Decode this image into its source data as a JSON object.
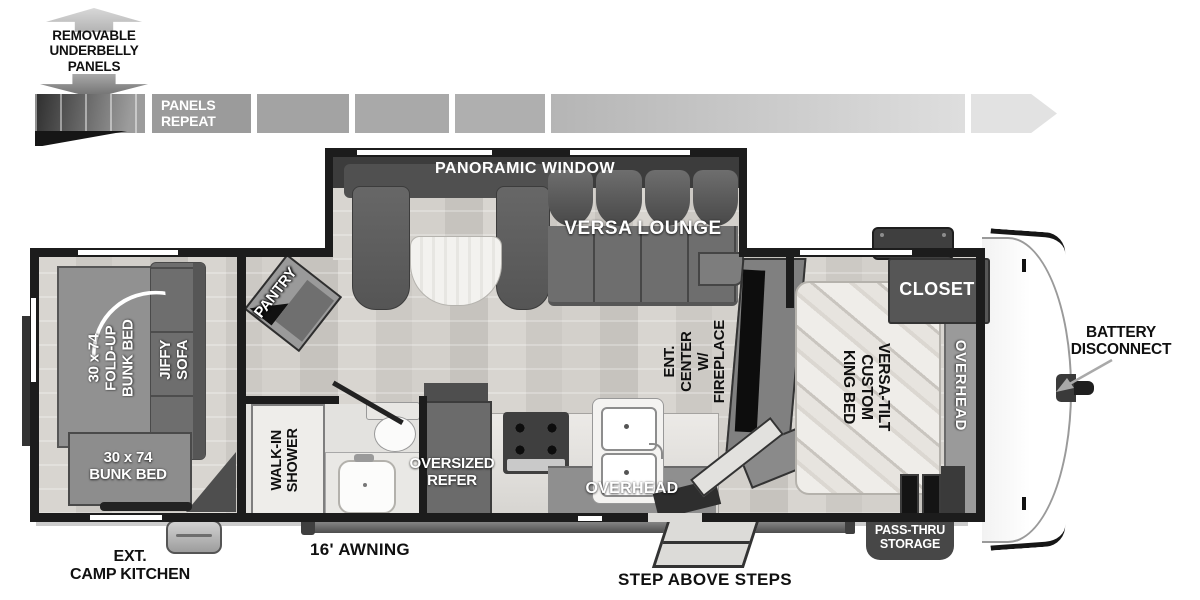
{
  "colors": {
    "wall": "#1c1c1c",
    "floor": "#d5d2cd",
    "furniture_gray": "#8e8e8e",
    "furniture_dark": "#575757",
    "label_white": "#ffffff",
    "label_black": "#101010",
    "panel_bar_gray": "#9b9b9b",
    "panel_bar_light": "#e2e2e2",
    "front_cap": "#fbfbfb"
  },
  "top": {
    "underbelly": "REMOVABLE\nUNDERBELLY\nPANELS",
    "panels_repeat": "PANELS\nREPEAT"
  },
  "plan": {
    "panoramic_window": "PANORAMIC WINDOW",
    "versa_lounge": "VERSA LOUNGE",
    "pantry": "PANTRY",
    "fold_up_bunk": "30 x 74\nFOLD-UP\nBUNK BED",
    "jiffy_sofa": "JIFFY SOFA",
    "bunk_bed": "30 x 74\nBUNK BED",
    "walk_in_shower": "WALK-IN\nSHOWER",
    "oversized_refer": "OVERSIZED\nREFER",
    "overhead_kitchen": "OVERHEAD",
    "ent_center": "ENT. CENTER\nW/ FIREPLACE",
    "closet": "CLOSET",
    "king_bed": "VERSA-TILT\nCUSTOM\nKING BED",
    "overhead_bedroom": "OVERHEAD"
  },
  "ext": {
    "battery": "BATTERY\nDISCONNECT",
    "camp_kitchen": "EXT.\nCAMP KITCHEN",
    "awning": "16' AWNING",
    "steps": "STEP ABOVE STEPS",
    "pass_thru": "PASS-THRU\nSTORAGE"
  }
}
